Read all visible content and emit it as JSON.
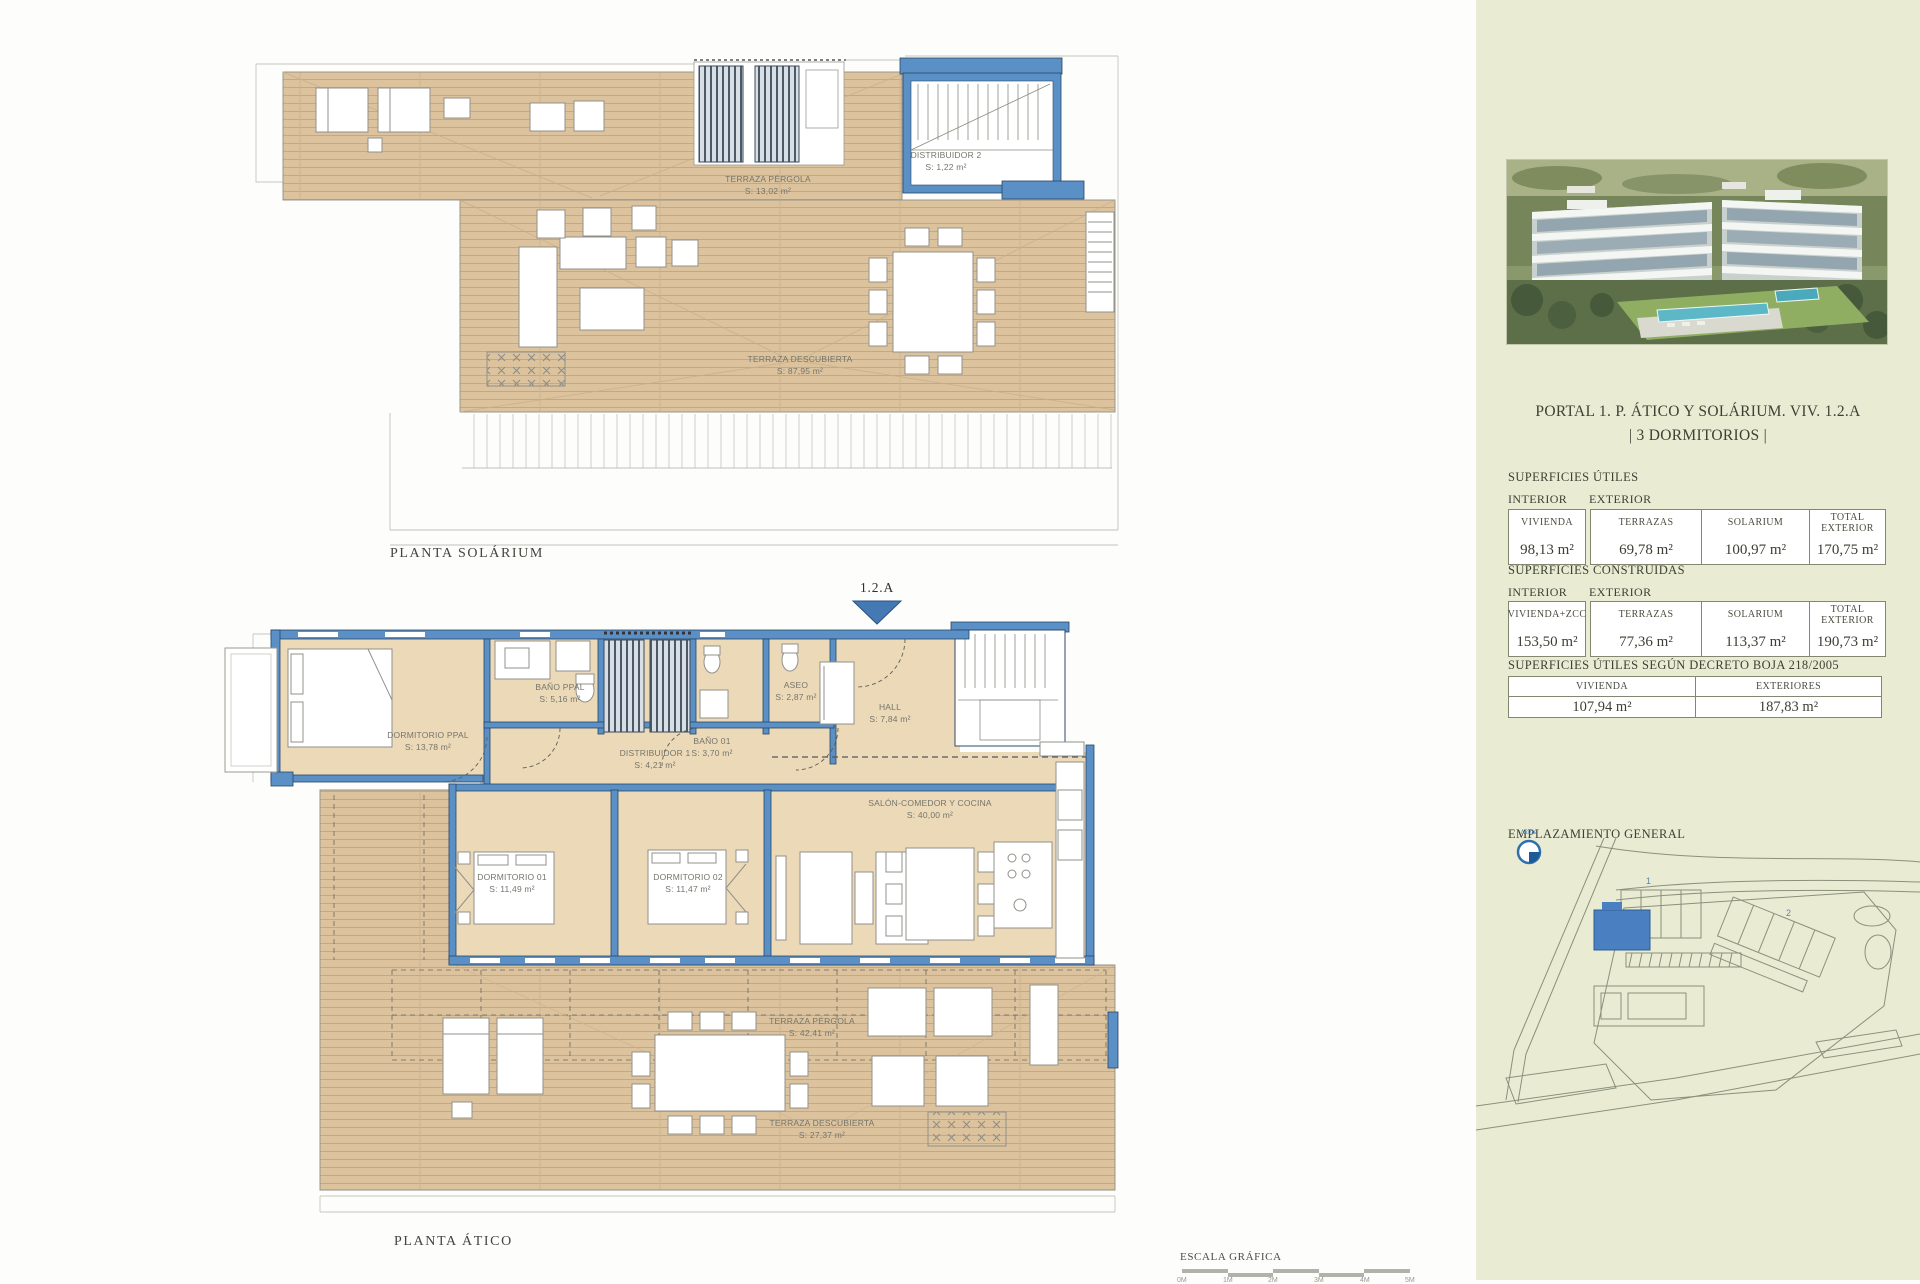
{
  "plans": {
    "solarium": {
      "title": "PLANTA SOLÁRIUM",
      "rooms": {
        "terraza_pergola": {
          "name": "TERRAZA PÉRGOLA",
          "area": "S: 13,02 m²"
        },
        "distribuidor2": {
          "name": "DISTRIBUIDOR 2",
          "area": "S: 1,22 m²"
        },
        "terraza_descubierta": {
          "name": "TERRAZA DESCUBIERTA",
          "area": "S: 87,95 m²"
        }
      }
    },
    "atico": {
      "title": "PLANTA ÁTICO",
      "unit_marker": "1.2.A",
      "rooms": {
        "dormitorio_ppal": {
          "name": "DORMITORIO PPAL",
          "area": "S: 13,78 m²"
        },
        "bano_ppal": {
          "name": "BAÑO PPAL",
          "area": "S: 5,16 m²"
        },
        "bano_01": {
          "name": "BAÑO 01",
          "area": "S: 3,70 m²"
        },
        "aseo": {
          "name": "ASEO",
          "area": "S: 2,87 m²"
        },
        "hall": {
          "name": "HALL",
          "area": "S: 7,84 m²"
        },
        "distribuidor1": {
          "name": "DISTRIBUIDOR 1",
          "area": "S: 4,21 m²"
        },
        "dormitorio_01": {
          "name": "DORMITORIO 01",
          "area": "S: 11,49 m²"
        },
        "dormitorio_02": {
          "name": "DORMITORIO 02",
          "area": "S: 11,47 m²"
        },
        "salon": {
          "name": "SALÓN-COMEDOR Y COCINA",
          "area": "S: 40,00 m²"
        },
        "terraza_pergola": {
          "name": "TERRAZA PÉRGOLA",
          "area": "S: 42,41 m²"
        },
        "terraza_descubierta": {
          "name": "TERRAZA DESCUBIERTA",
          "area": "S: 27,37 m²"
        }
      }
    }
  },
  "scale": {
    "label": "ESCALA GRÁFICA",
    "ticks": [
      "0M",
      "1M",
      "2M",
      "3M",
      "4M",
      "5M"
    ]
  },
  "sidebar": {
    "title_line1": "PORTAL 1. P. ÁTICO Y SOLÁRIUM. VIV. 1.2.A",
    "title_line2": "| 3 DORMITORIOS |",
    "sections": {
      "utiles": {
        "title": "SUPERFICIES ÚTILES",
        "interior_label": "INTERIOR",
        "exterior_label": "EXTERIOR",
        "interior_col": {
          "header": "VIVIENDA",
          "value": "98,13 m²"
        },
        "exterior_cols": [
          {
            "header": "TERRAZAS",
            "value": "69,78 m²"
          },
          {
            "header": "SOLARIUM",
            "value": "100,97 m²"
          },
          {
            "header": "TOTAL EXTERIOR",
            "value": "170,75 m²"
          }
        ]
      },
      "construidas": {
        "title": "SUPERFICIES CONSTRUIDAS",
        "interior_label": "INTERIOR",
        "exterior_label": "EXTERIOR",
        "interior_col": {
          "header": "VIVIENDA+ZCC",
          "value": "153,50 m²"
        },
        "exterior_cols": [
          {
            "header": "TERRAZAS",
            "value": "77,36 m²"
          },
          {
            "header": "SOLARIUM",
            "value": "113,37 m²"
          },
          {
            "header": "TOTAL EXTERIOR",
            "value": "190,73 m²"
          }
        ]
      },
      "boja": {
        "title": "SUPERFICIES ÚTILES SEGÚN DECRETO BOJA 218/2005",
        "cols": [
          {
            "header": "VIVIENDA",
            "value": "107,94 m²"
          },
          {
            "header": "EXTERIORES",
            "value": "187,83 m²"
          }
        ]
      }
    },
    "emplazamiento_label": "EMPLAZAMIENTO GENERAL",
    "map": {
      "north_label": "Norte",
      "building1_label": "1",
      "building2_label": "2"
    }
  }
}
